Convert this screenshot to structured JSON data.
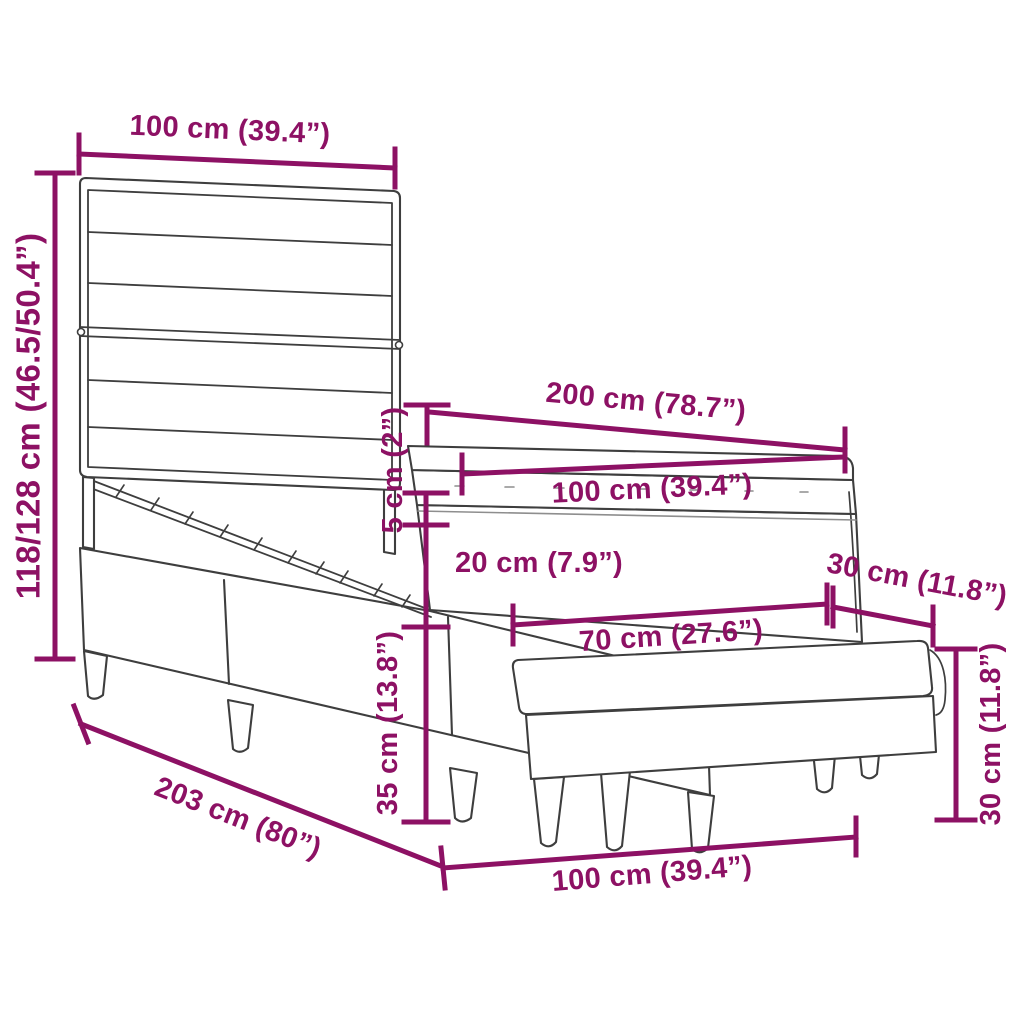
{
  "diagram": {
    "type": "product-dimension-diagram",
    "subject": "box-spring-bed-with-headboard-and-bench",
    "colors": {
      "dimension": "#8D1164",
      "outline": "#3E3E3E",
      "outline_light": "#8E8E8E",
      "background": "#FFFFFF"
    },
    "labels": {
      "headboard_width": "100 cm (39.4”)",
      "bed_height": "118/128 cm (46.5/50.4”)",
      "bed_length": "200 cm (78.7”)",
      "mattress_width": "100 cm (39.4”)",
      "topper_thickness": "5 cm (2”)",
      "mattress_thickness": "20 cm (7.9”)",
      "base_height": "35 cm (13.8”)",
      "bench_top_length": "70 cm (27.6”)",
      "bench_top_side": "30 cm (11.8”)",
      "frame_length": "203 cm (80”)",
      "bench_width": "100 cm (39.4”)",
      "bench_height": "30 cm (11.8”)"
    }
  }
}
